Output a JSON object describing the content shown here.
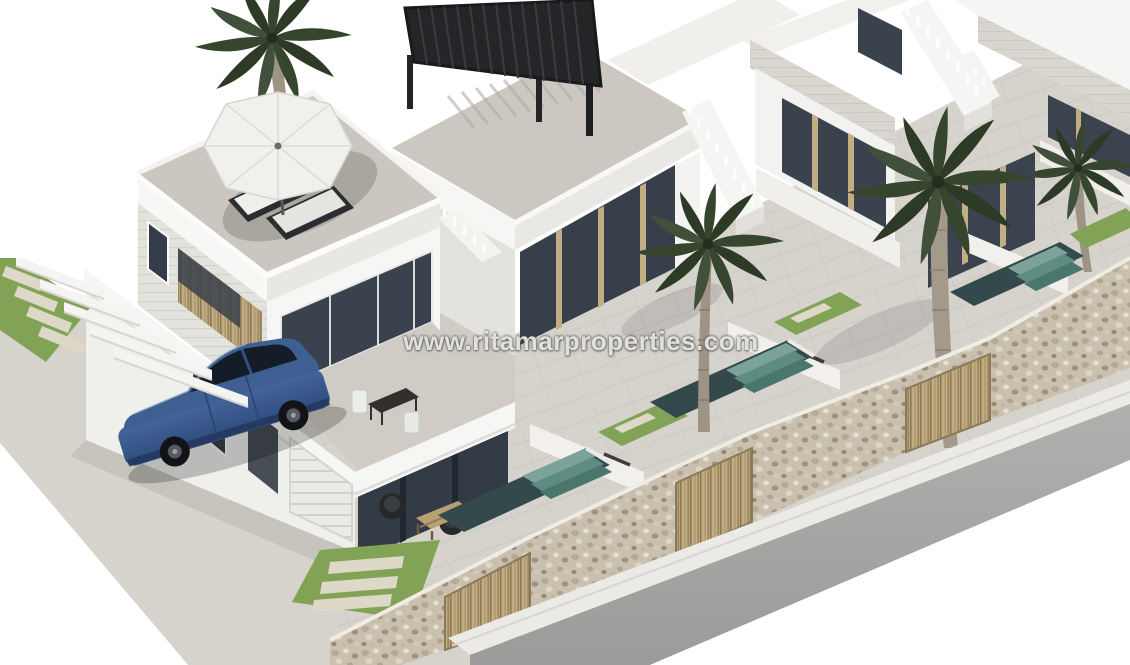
{
  "page": {
    "background": "#ffffff",
    "type": "3d-architectural-render",
    "description": "Isometric 3D real-estate rendering of a row of modern white two-storey villas with roof terraces, private pools with step entries, lawns with pavers, a stone street wall with wooden slat gates, palm trees, and a blue sedan parked under white carport beams beside the first villa."
  },
  "watermark": {
    "text": "www.ritamarproperties.com"
  },
  "scene": {
    "palette": {
      "wall_white": "#f5f5f3",
      "wall_shade": "#e7e5e0",
      "fascia_gray": "#d9d6d0",
      "terrace_tile": "#d3cfc9",
      "glass_dark": "#39424d",
      "wood_slat": "#c0ab82",
      "stone_wall": "#c9c0b0",
      "lawn_green": "#82a355",
      "pool_teal": "#5f8c81",
      "pool_deep": "#33494b",
      "road_gray": "#a9a7a5",
      "curb_white": "#eceae6",
      "car_blue": "#3b5684",
      "pergola_black": "#26282a",
      "palm_green": "#36452e"
    },
    "objects": [
      {
        "name": "villa-1",
        "label": "Two-storey white villa with roof terrace"
      },
      {
        "name": "parasol",
        "label": "White octagonal roof-terrace parasol"
      },
      {
        "name": "sun-loungers",
        "label": "Two sun loungers with white cushions"
      },
      {
        "name": "pergola",
        "label": "Black slatted aluminium pergola on roof terrace"
      },
      {
        "name": "villa-2",
        "label": "Second villa with pergola roof terrace"
      },
      {
        "name": "villa-3",
        "label": "Third villa in the row"
      },
      {
        "name": "villa-4",
        "label": "Fourth villa, top right corner"
      },
      {
        "name": "stair-balustrade",
        "label": "White stepped stair parapets with balusters"
      },
      {
        "name": "palm-tree",
        "label": "Four palm trees"
      },
      {
        "name": "swimming-pool",
        "label": "Three private pools with striped step entries"
      },
      {
        "name": "lawn",
        "label": "Green lawns with pale stepping pavers"
      },
      {
        "name": "stone-wall",
        "label": "Pebble-stone street boundary wall"
      },
      {
        "name": "wooden-gate",
        "label": "Vertical wooden slat gates"
      },
      {
        "name": "car",
        "label": "Blue sedan parked in the driveway"
      },
      {
        "name": "carport-beams",
        "label": "White cantilever carport beams"
      },
      {
        "name": "road",
        "label": "Gray asphalt street"
      },
      {
        "name": "curb",
        "label": "White curb / sidewalk edge"
      },
      {
        "name": "balcony-furniture",
        "label": "Bistro table and chairs on balcony"
      },
      {
        "name": "terrace-furniture",
        "label": "Rattan chairs and wooden coffee table"
      },
      {
        "name": "garage-door",
        "label": "White sectional garage door"
      }
    ]
  }
}
